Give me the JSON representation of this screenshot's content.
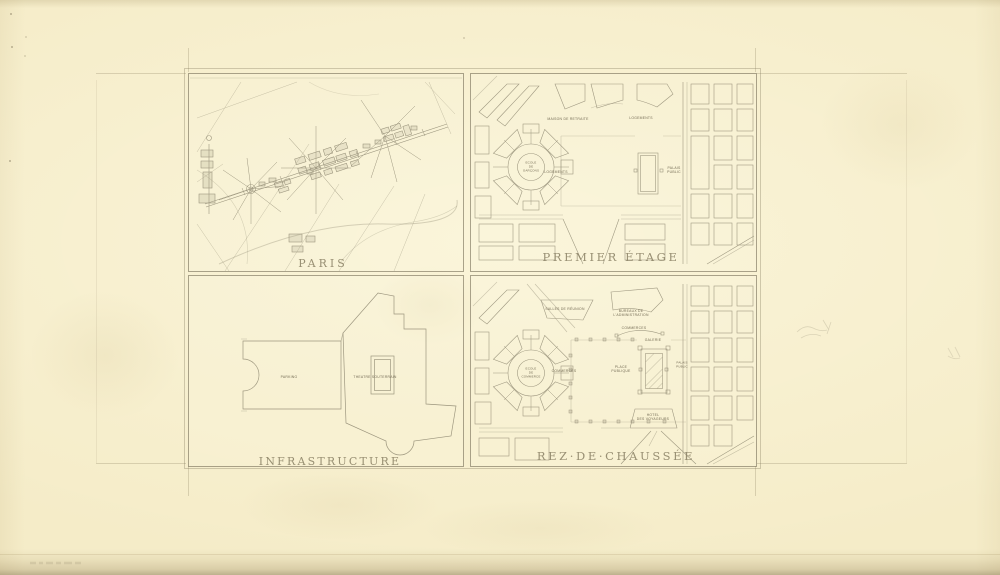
{
  "sheet": {
    "quadrants": {
      "paris": {
        "title": "PARIS"
      },
      "premier_etage": {
        "title": "PREMIER ÉTAGE",
        "labels": {
          "maison": "MAISON DE RETRAITE",
          "logements_haut": "LOGEMENTS",
          "ecole": "ECOLE\nDE\nGARÇONS",
          "logements": "LOGEMENTS",
          "palais": "PALAIS\nPUBLIC"
        }
      },
      "infrastructure": {
        "title": "INFRASTRUCTURE",
        "labels": {
          "parking": "PARKING",
          "theatre": "THEATRE SOUTERRAIN"
        }
      },
      "rez_de_chaussee": {
        "title": "REZ·DE·CHAUSSÉE",
        "labels": {
          "salles": "SALLES DE RÉUNION",
          "bureaux": "BUREAUX DE\nL'ADMINISTRATION",
          "commerces_haut": "COMMERCES",
          "galerie": "GALERIE",
          "place": "PLACE\nPUBLIQUE",
          "commerces": "COMMERCES",
          "ecole": "ECOLE\nDE\nCOMMERCE",
          "palais": "PALAIS\nPUBLIC",
          "hotel": "HOTEL\nDES VOYAGEURS"
        }
      }
    },
    "colors": {
      "paper": "#f5ecc8",
      "ink": "#87806a",
      "title": "#8b8266",
      "edge_shadow": "#c9ba8f"
    }
  }
}
